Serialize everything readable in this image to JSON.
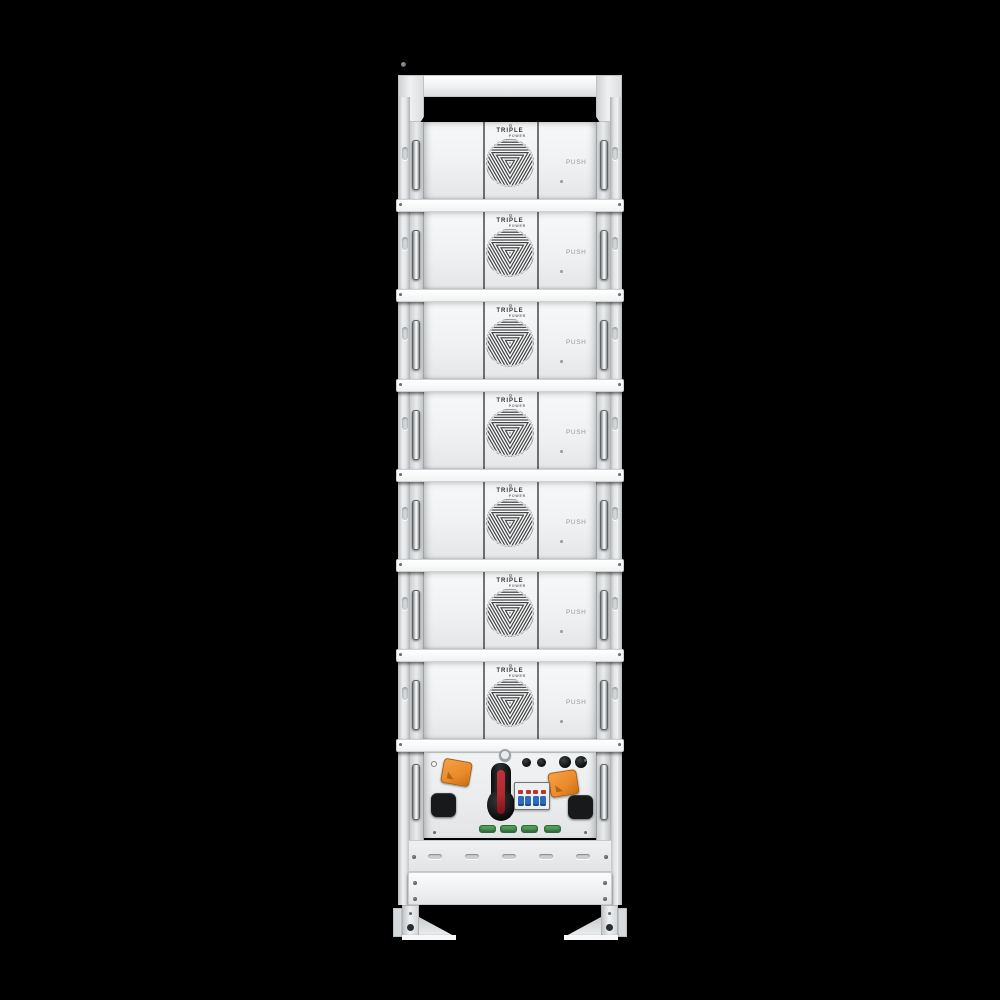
{
  "scene": {
    "description": "Front-view product render of a white stacked battery energy storage rack tower on a black background",
    "background_color": "#000000"
  },
  "product": {
    "brand_top": "TRIPLE",
    "brand_bottom": "POWER",
    "push_label": "PUSH",
    "module_count": 7
  },
  "modules": [
    {
      "id": "battery-module-1"
    },
    {
      "id": "battery-module-2"
    },
    {
      "id": "battery-module-3"
    },
    {
      "id": "battery-module-4"
    },
    {
      "id": "battery-module-5"
    },
    {
      "id": "battery-module-6"
    },
    {
      "id": "battery-module-7"
    }
  ],
  "control_unit": {
    "components": [
      "orange-connector",
      "orange-connector",
      "dc-disconnect-switch",
      "circuit-breaker-4-pole",
      "black-port",
      "black-port",
      "round-connector",
      "round-connector",
      "round-connector",
      "round-connector",
      "green-terminal",
      "green-terminal",
      "green-terminal",
      "green-terminal"
    ]
  },
  "colors": {
    "rack_body": "#eef0f1",
    "separator": "#fbfcfd",
    "connector_orange": "#e98a2b",
    "switch_handle_black": "#17191b",
    "switch_stripe_red": "#b02a30",
    "breaker_blue": "#2d6cba",
    "terminal_green": "#4f9c58",
    "fan_slat": "#3c3e3f"
  }
}
